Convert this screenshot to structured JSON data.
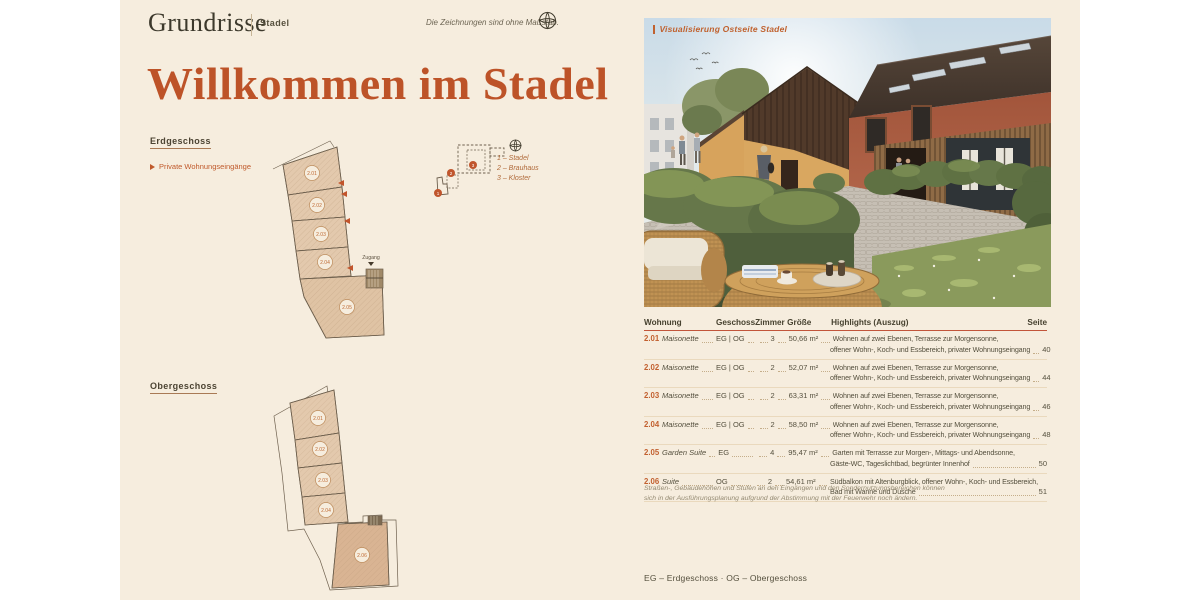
{
  "header": {
    "brand": "Grundrisse",
    "project": "Stadel",
    "note": "Die Zeichnungen sind ohne Maßstab."
  },
  "title": "Willkommen im Stadel",
  "plans": {
    "eg": {
      "label": "Erdgeschoss",
      "legend": "Private Wohnungseingänge",
      "zugang": "Zugang",
      "units": [
        "2.01",
        "2.02",
        "2.03",
        "2.04",
        "2.05"
      ]
    },
    "og": {
      "label": "Obergeschoss",
      "units": [
        "2.01",
        "2.02",
        "2.03",
        "2.04",
        "2.06"
      ]
    },
    "site": {
      "items": [
        "1 – Stadel",
        "2 – Brauhaus",
        "3 – Kloster"
      ],
      "markers": [
        "1",
        "2",
        "3"
      ]
    }
  },
  "photo": {
    "caption": "Visualisierung Ostseite Stadel"
  },
  "table": {
    "headers": {
      "wohnung": "Wohnung",
      "geschoss": "Geschoss",
      "zimmer": "Zimmer",
      "groesse": "Größe",
      "highlights": "Highlights (Auszug)",
      "seite": "Seite"
    },
    "rows": [
      {
        "no": "2.01",
        "type": "Maisonette",
        "geschoss": "EG | OG",
        "zimmer": "3",
        "groesse": "50,66 m²",
        "h1": "Wohnen auf zwei Ebenen, Terrasse zur Morgensonne,",
        "h2": "offener Wohn-, Koch- und Essbereich, privater Wohnungseingang",
        "seite": "40"
      },
      {
        "no": "2.02",
        "type": "Maisonette",
        "geschoss": "EG | OG",
        "zimmer": "2",
        "groesse": "52,07 m²",
        "h1": "Wohnen auf zwei Ebenen, Terrasse zur Morgensonne,",
        "h2": "offener Wohn-, Koch- und Essbereich, privater Wohnungseingang",
        "seite": "44"
      },
      {
        "no": "2.03",
        "type": "Maisonette",
        "geschoss": "EG | OG",
        "zimmer": "2",
        "groesse": "63,31 m²",
        "h1": "Wohnen auf zwei Ebenen, Terrasse zur Morgensonne,",
        "h2": "offener Wohn-, Koch- und Essbereich, privater Wohnungseingang",
        "seite": "46"
      },
      {
        "no": "2.04",
        "type": "Maisonette",
        "geschoss": "EG | OG",
        "zimmer": "2",
        "groesse": "58,50 m²",
        "h1": "Wohnen auf zwei Ebenen, Terrasse zur Morgensonne,",
        "h2": "offener Wohn-, Koch- und Essbereich, privater Wohnungseingang",
        "seite": "48"
      },
      {
        "no": "2.05",
        "type": "Garden Suite",
        "geschoss": "EG",
        "zimmer": "4",
        "groesse": "95,47 m²",
        "h1": "Garten mit Terrasse zur Morgen-, Mittags- und Abendsonne,",
        "h2": "Gäste-WC, Tageslichtbad, begrünter Innenhof",
        "seite": "50"
      },
      {
        "no": "2.06",
        "type": "Suite",
        "geschoss": "OG",
        "zimmer": "2",
        "groesse": "54,61 m²",
        "h1": "Südbalkon mit Altenburgblick, offener Wohn-, Koch- und Essbereich,",
        "h2": "Bad mit Wanne und Dusche",
        "seite": "51"
      }
    ],
    "footnote_line1": "Straßen-, Gebäudehöhen und Stufen an den Eingängen und den Sondernutzungsbereichen können",
    "footnote_line2": "sich in der Ausführungsplanung aufgrund der Abstimmung mit der Feuerwehr noch ändern."
  },
  "footer": {
    "abbreviations": "EG – Erdgeschoss  ·  OG – Obergeschoss"
  },
  "colors": {
    "accent": "#c05a2c",
    "cream": "#f6edde",
    "ink": "#4c4735",
    "plan_fill": "#e3c9ad"
  }
}
